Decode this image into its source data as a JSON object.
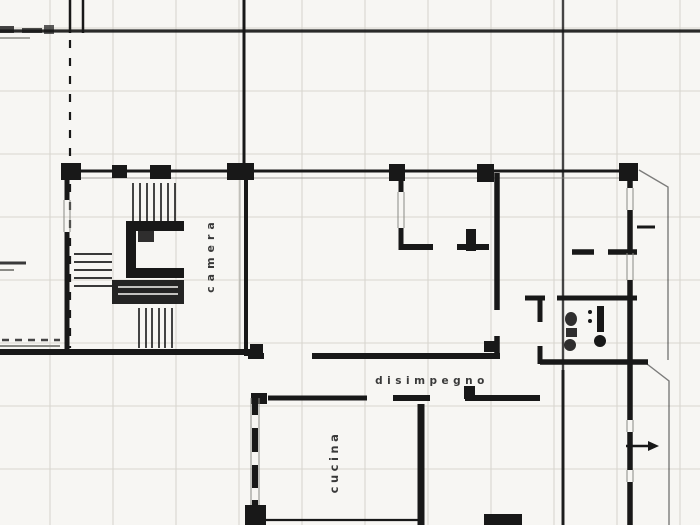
{
  "drawing": {
    "labels": {
      "camera": "camera",
      "disimpegno": "disimpegno",
      "cucina": "cucina"
    },
    "colors": {
      "ink": "#181818",
      "paper": "#f7f6f3",
      "grid": "#d8d6cf",
      "light_ink": "#8a8a85"
    }
  }
}
